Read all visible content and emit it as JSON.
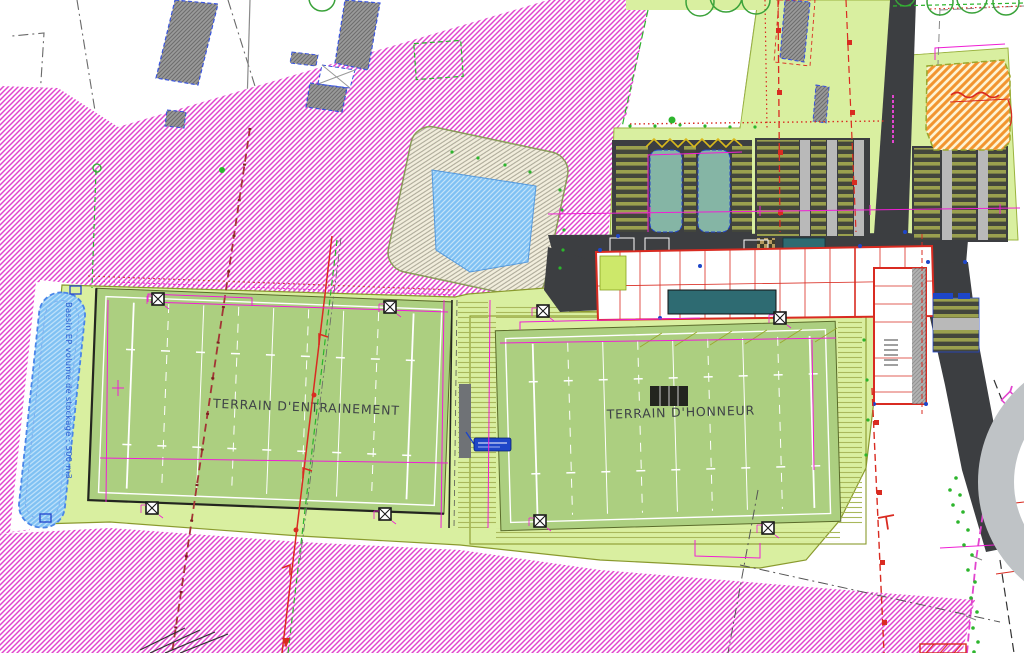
{
  "drawing": {
    "type": "site-plan",
    "labels": {
      "training_field": "TERRAIN D'ENTRAINEMENT",
      "main_field": "TERRAIN D'HONNEUR",
      "basin_note": "Bassin EP volume de stockage : 500 m3"
    },
    "colors": {
      "magenta": "#e245cf",
      "orange_hatch": "#f2952f",
      "platform_green": "#d9efa0",
      "field_green": "#accf80",
      "pond_blue": "#7fc1f3",
      "road_dark": "#3c3e41",
      "red_line": "#d92b21",
      "dim_magenta": "#ef1fd4",
      "building_gray": "#8f8f8f",
      "stall_olive": "#9aa04e",
      "teal_dark": "#2e6b72",
      "lime_patio": "#cde86a",
      "blue_accent": "#1e46c8",
      "green_dot": "#2db52d",
      "olive_edge": "#8a9a2e",
      "arc_gray": "#bfc3c6"
    }
  }
}
